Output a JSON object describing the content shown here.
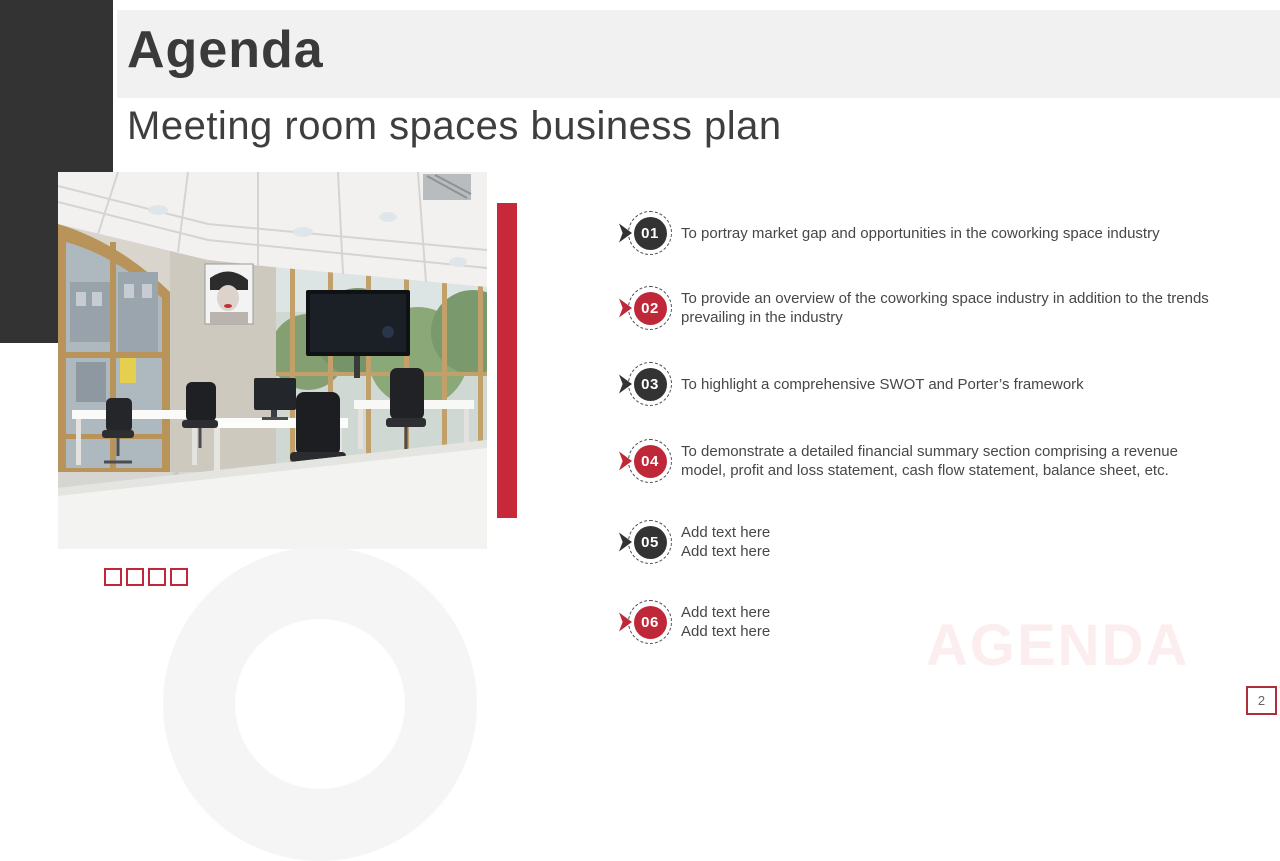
{
  "slide": {
    "title": "Agenda",
    "subtitle": "Meeting room spaces business plan",
    "watermark": "AGENDA",
    "page_number": "2"
  },
  "agenda_items": [
    {
      "number": "01",
      "style": "dark",
      "text": "To portray market gap and opportunities in the coworking space industry"
    },
    {
      "number": "02",
      "style": "red",
      "text": "To provide an overview of the coworking space industry in addition to the trends\nprevailing in the industry"
    },
    {
      "number": "03",
      "style": "dark",
      "text": "To highlight a comprehensive SWOT and Porter’s framework"
    },
    {
      "number": "04",
      "style": "red",
      "text": "To demonstrate a detailed financial summary section comprising a revenue\nmodel, profit and loss statement, cash flow statement, balance sheet, etc."
    },
    {
      "number": "05",
      "style": "dark",
      "text": "Add text here\nAdd text here"
    },
    {
      "number": "06",
      "style": "red",
      "text": "Add text here\nAdd text here"
    }
  ],
  "icons": {
    "ribbon_pointer": "ribbon-pointer-icon",
    "decoration_squares_count": 4
  },
  "colors": {
    "accent_red": "#c8293a",
    "badge_red": "#be2838",
    "badge_dark": "#333333",
    "corner_block": "#333333",
    "title_band": "#f1f1f1",
    "watermark_pink": "#fceeee",
    "page_border_red": "#ac2f3a"
  }
}
